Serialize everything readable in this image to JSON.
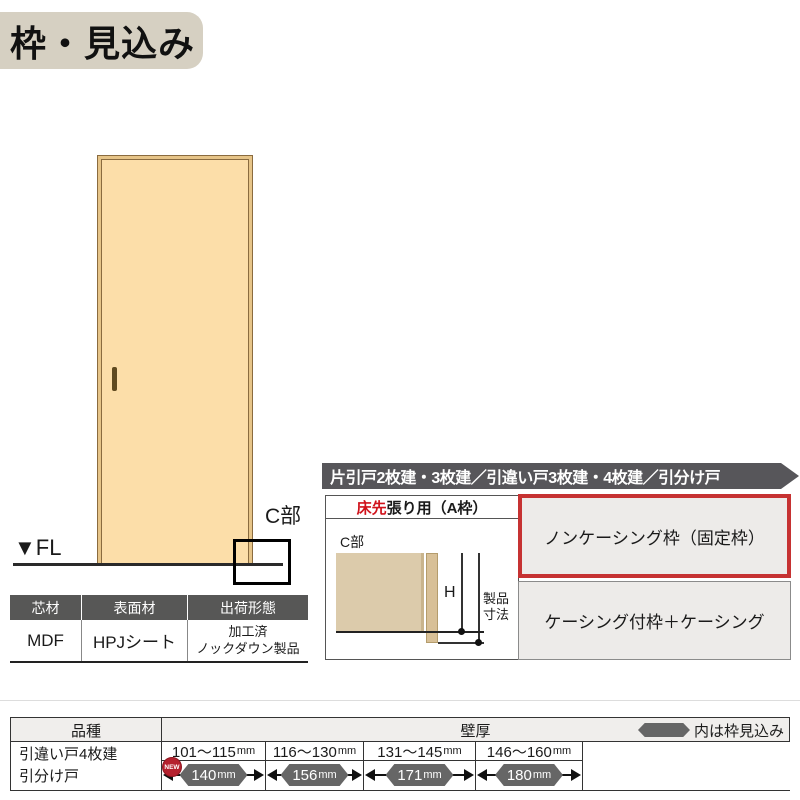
{
  "title": "枠・見込み",
  "door_figure": {
    "fl_label": "▼FL",
    "c_part_label": "C部"
  },
  "materials_table": {
    "headers": [
      "芯材",
      "表面材",
      "出荷形態"
    ],
    "core": "MDF",
    "surface": "HPJシート",
    "shipping_line1": "加工済",
    "shipping_line2": "ノックダウン製品"
  },
  "panel": {
    "banner": "片引戸2枚建・3枚建／引違い戸3枚建・4枚建／引分け戸",
    "floor_header_red": "床先",
    "floor_header_rest": "張り用（A枠）",
    "diagram": {
      "c_part_label": "C部",
      "height_label": "H",
      "product_dim_line1": "製品",
      "product_dim_line2": "寸法"
    },
    "option_noncasing": "ノンケーシング枠（固定枠）",
    "option_casing": "ケーシング付枠＋ケーシング"
  },
  "spec_table": {
    "product_header": "品種",
    "wall_header": "壁厚",
    "legend_text": "内は枠見込み",
    "product_line1": "引違い戸4枚建",
    "product_line2": "引分け戸",
    "new_badge": "NEW",
    "columns": [
      {
        "range": "101～115",
        "range_unit": "mm",
        "frame": "140",
        "frame_unit": "mm"
      },
      {
        "range": "116～130",
        "range_unit": "mm",
        "frame": "156",
        "frame_unit": "mm"
      },
      {
        "range": "131～145",
        "range_unit": "mm",
        "frame": "171",
        "frame_unit": "mm"
      },
      {
        "range": "146～160",
        "range_unit": "mm",
        "frame": "180",
        "frame_unit": "mm"
      }
    ]
  },
  "colors": {
    "title_bg": "#d6d0c2",
    "door_fill": "#fcdea9",
    "door_edge": "#8a6b3f",
    "banner_bg": "#57565a",
    "highlight_red_border": "#c63232",
    "accent_red_text": "#d0121b",
    "option_cell_gray": "#edebe9",
    "table_header_dark": "#575756",
    "hexagon_gray": "#666666",
    "new_badge_red": "#b5212e"
  }
}
